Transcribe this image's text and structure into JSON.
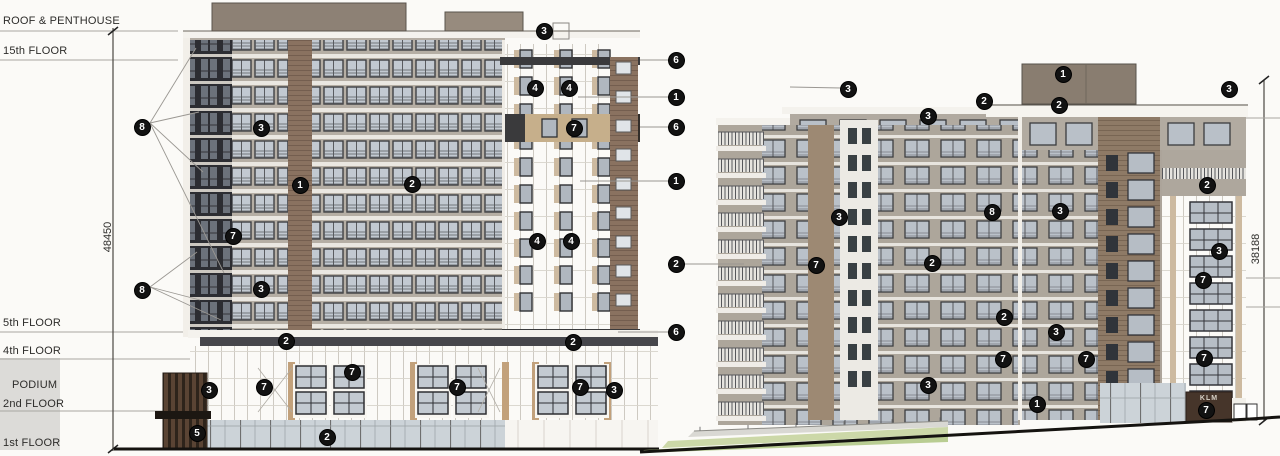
{
  "drawing": {
    "floor_labels": [
      {
        "text": "ROOF & PENTHOUSE"
      },
      {
        "text": "15th FLOOR"
      },
      {
        "text": "5th FLOOR"
      },
      {
        "text": "4th FLOOR"
      },
      {
        "text": "PODIUM"
      },
      {
        "text": "2nd FLOOR"
      },
      {
        "text": "1st FLOOR"
      }
    ],
    "dimensions": {
      "left_height": "48450",
      "right_height": "38188"
    },
    "signage": {
      "entry_sign": "KLM"
    },
    "callouts": [
      {
        "n": "8",
        "x": 142,
        "y": 127
      },
      {
        "n": "3",
        "x": 261,
        "y": 128
      },
      {
        "n": "1",
        "x": 300,
        "y": 185
      },
      {
        "n": "2",
        "x": 412,
        "y": 184
      },
      {
        "n": "7",
        "x": 233,
        "y": 236
      },
      {
        "n": "8",
        "x": 142,
        "y": 290
      },
      {
        "n": "3",
        "x": 261,
        "y": 289
      },
      {
        "n": "3",
        "x": 544,
        "y": 31
      },
      {
        "n": "4",
        "x": 535,
        "y": 88
      },
      {
        "n": "4",
        "x": 569,
        "y": 88
      },
      {
        "n": "7",
        "x": 574,
        "y": 128
      },
      {
        "n": "4",
        "x": 537,
        "y": 241
      },
      {
        "n": "4",
        "x": 571,
        "y": 241
      },
      {
        "n": "2",
        "x": 286,
        "y": 341
      },
      {
        "n": "2",
        "x": 573,
        "y": 342
      },
      {
        "n": "3",
        "x": 209,
        "y": 390
      },
      {
        "n": "7",
        "x": 264,
        "y": 387
      },
      {
        "n": "7",
        "x": 352,
        "y": 372
      },
      {
        "n": "7",
        "x": 457,
        "y": 387
      },
      {
        "n": "7",
        "x": 580,
        "y": 387
      },
      {
        "n": "3",
        "x": 614,
        "y": 390
      },
      {
        "n": "5",
        "x": 197,
        "y": 433
      },
      {
        "n": "2",
        "x": 327,
        "y": 437
      },
      {
        "n": "6",
        "x": 676,
        "y": 60
      },
      {
        "n": "1",
        "x": 676,
        "y": 97
      },
      {
        "n": "6",
        "x": 676,
        "y": 127
      },
      {
        "n": "1",
        "x": 676,
        "y": 181
      },
      {
        "n": "2",
        "x": 676,
        "y": 264
      },
      {
        "n": "6",
        "x": 676,
        "y": 332
      },
      {
        "n": "3",
        "x": 848,
        "y": 89
      },
      {
        "n": "2",
        "x": 984,
        "y": 101
      },
      {
        "n": "3",
        "x": 928,
        "y": 116
      },
      {
        "n": "1",
        "x": 1063,
        "y": 74
      },
      {
        "n": "2",
        "x": 1059,
        "y": 105
      },
      {
        "n": "3",
        "x": 1229,
        "y": 89
      },
      {
        "n": "3",
        "x": 839,
        "y": 217
      },
      {
        "n": "8",
        "x": 992,
        "y": 212
      },
      {
        "n": "3",
        "x": 1060,
        "y": 211
      },
      {
        "n": "2",
        "x": 932,
        "y": 263
      },
      {
        "n": "7",
        "x": 816,
        "y": 265
      },
      {
        "n": "2",
        "x": 1207,
        "y": 185
      },
      {
        "n": "3",
        "x": 1219,
        "y": 251
      },
      {
        "n": "7",
        "x": 1203,
        "y": 280
      },
      {
        "n": "2",
        "x": 1004,
        "y": 317
      },
      {
        "n": "3",
        "x": 1056,
        "y": 332
      },
      {
        "n": "7",
        "x": 1003,
        "y": 359
      },
      {
        "n": "7",
        "x": 1086,
        "y": 359
      },
      {
        "n": "3",
        "x": 928,
        "y": 385
      },
      {
        "n": "1",
        "x": 1037,
        "y": 404
      },
      {
        "n": "7",
        "x": 1204,
        "y": 358
      },
      {
        "n": "7",
        "x": 1206,
        "y": 410
      }
    ],
    "palette": {
      "background": "#fbfaf7",
      "annotation_line": "#a9a7a2",
      "dim_line": "#4b4843",
      "label_text": "#2d2c2a",
      "callout_bg": "#121212",
      "callout_text": "#ffffff",
      "podium_gray": "#dcdbd8",
      "facade_taupe": "#b5aea4",
      "facade_taupe_b": "#ada69b",
      "dark_glazing": "#2c2d32",
      "masonry_brown": "#8a7260",
      "panel_white": "#fbfaf7",
      "wood_tan": "#c6af8b",
      "charcoal_band": "#3a3a3c",
      "glass": "#c2c9d1",
      "slab": "#eae7e1",
      "ground": "#151310",
      "grass_light": "#ccd8a8",
      "grass_dark": "#b9cd92",
      "walkway": "#d9d8d3"
    }
  }
}
